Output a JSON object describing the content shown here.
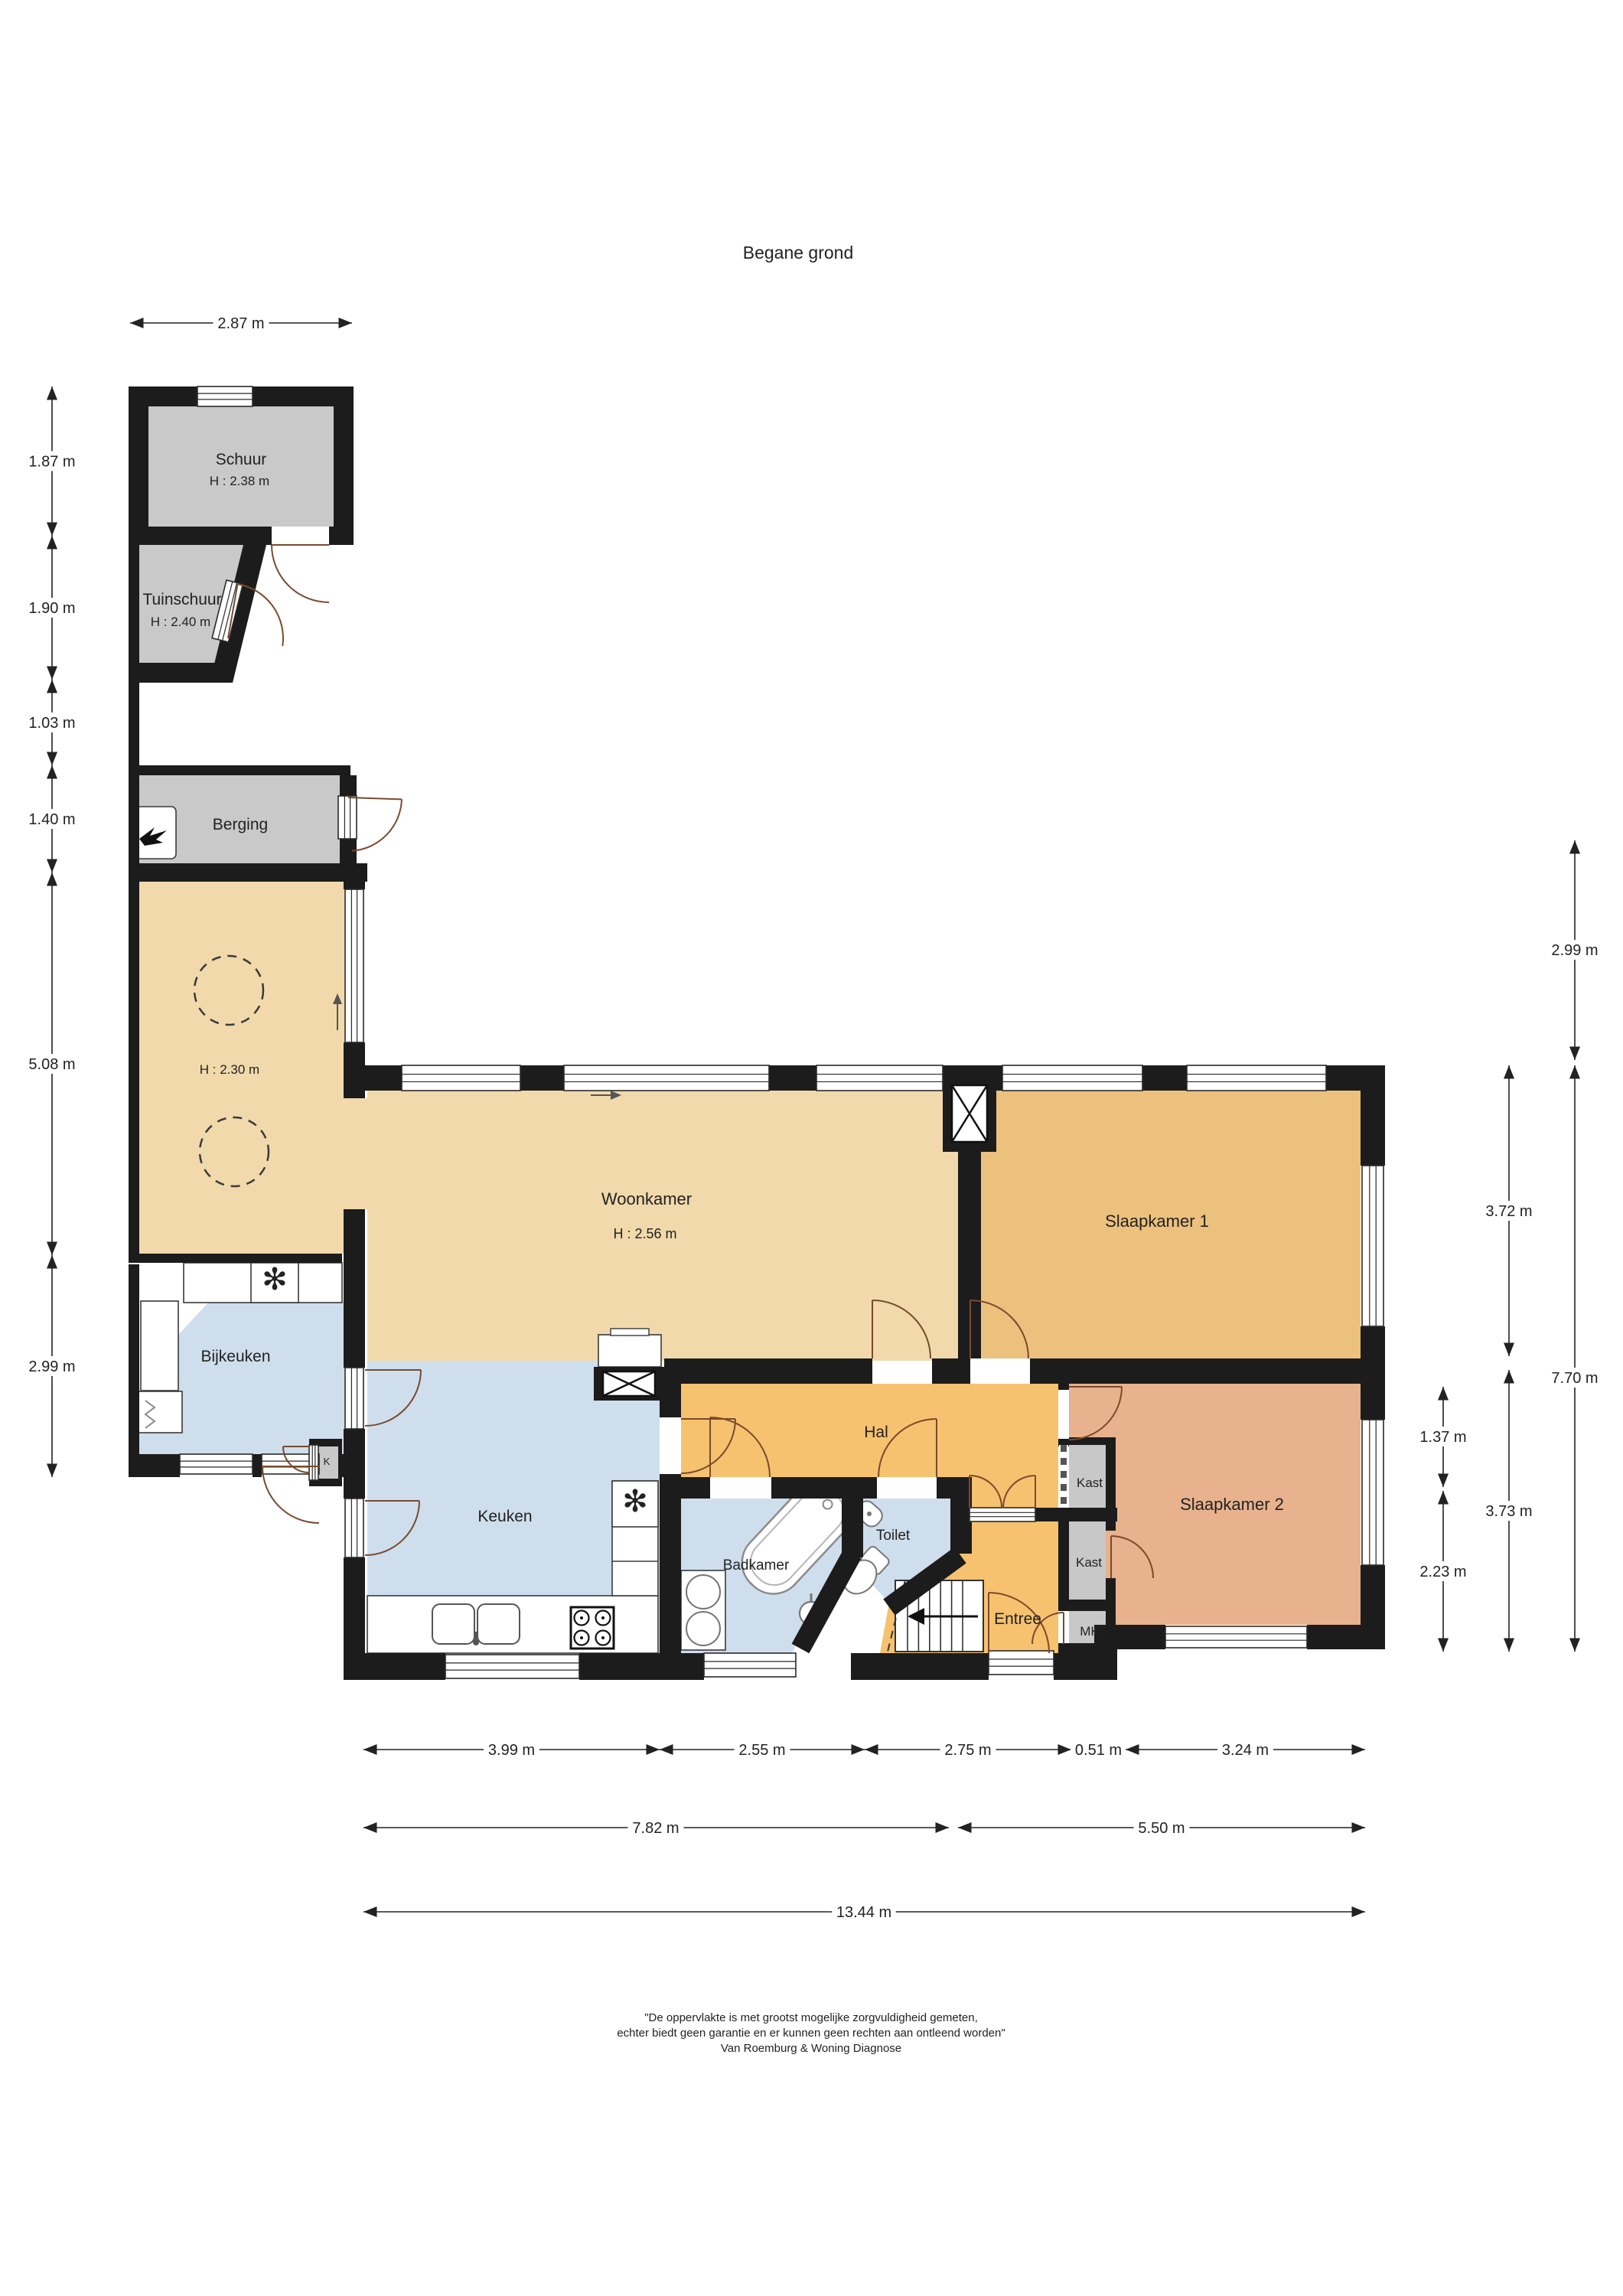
{
  "title": "Begane grond",
  "rooms": {
    "schuur": {
      "label": "Schuur",
      "height": "H : 2.38 m"
    },
    "tuinschuur": {
      "label": "Tuinschuur",
      "height": "H : 2.40 m"
    },
    "berging": {
      "label": "Berging"
    },
    "garage": {
      "height": "H : 2.30 m"
    },
    "woonkamer": {
      "label": "Woonkamer",
      "height": "H : 2.56 m"
    },
    "slaapkamer1": {
      "label": "Slaapkamer 1"
    },
    "bijkeuken": {
      "label": "Bijkeuken"
    },
    "keuken": {
      "label": "Keuken"
    },
    "hal": {
      "label": "Hal"
    },
    "toilet": {
      "label": "Toilet"
    },
    "badkamer": {
      "label": "Badkamer"
    },
    "entree": {
      "label": "Entree"
    },
    "slaapkamer2": {
      "label": "Slaapkamer 2"
    },
    "kast_boven": {
      "label": "Kast"
    },
    "kast_onder": {
      "label": "Kast"
    },
    "mk": {
      "label": "MK"
    },
    "k": {
      "label": "K"
    }
  },
  "dimensions": {
    "top": [
      "2.87 m"
    ],
    "left": [
      "1.87 m",
      "1.90 m",
      "1.03 m",
      "1.40 m",
      "5.08 m",
      "2.99 m"
    ],
    "right_outer": [
      "2.99 m",
      "7.70 m"
    ],
    "right_middle": [
      "3.72 m",
      "3.73 m"
    ],
    "right_inner": [
      "1.37 m",
      "2.23 m"
    ],
    "bottom_row1": [
      "3.99 m",
      "2.55 m",
      "2.75 m",
      "0.51 m",
      "3.24 m"
    ],
    "bottom_row2": [
      "7.82 m",
      "5.50 m"
    ],
    "bottom_row3": [
      "13.44 m"
    ]
  },
  "footer": {
    "line1": "\"De oppervlakte is met grootst mogelijke zorgvuldigheid gemeten,",
    "line2": "echter biedt geen garantie en er kunnen geen rechten aan ontleend worden\"",
    "line3": "Van Roemburg & Woning Diagnose"
  },
  "icons": {
    "fan": "✻"
  },
  "colors": {
    "wall": "#1c1c1c",
    "shed": "#c9c9c9",
    "living": "#f1d9ab",
    "bedroom1": "#ecc17d",
    "bedroom2": "#e7b28d",
    "hall": "#f6c26f",
    "wet": "#cfdeed",
    "closet": "#c8c8c8",
    "door_arc": "#7a4a2e"
  }
}
